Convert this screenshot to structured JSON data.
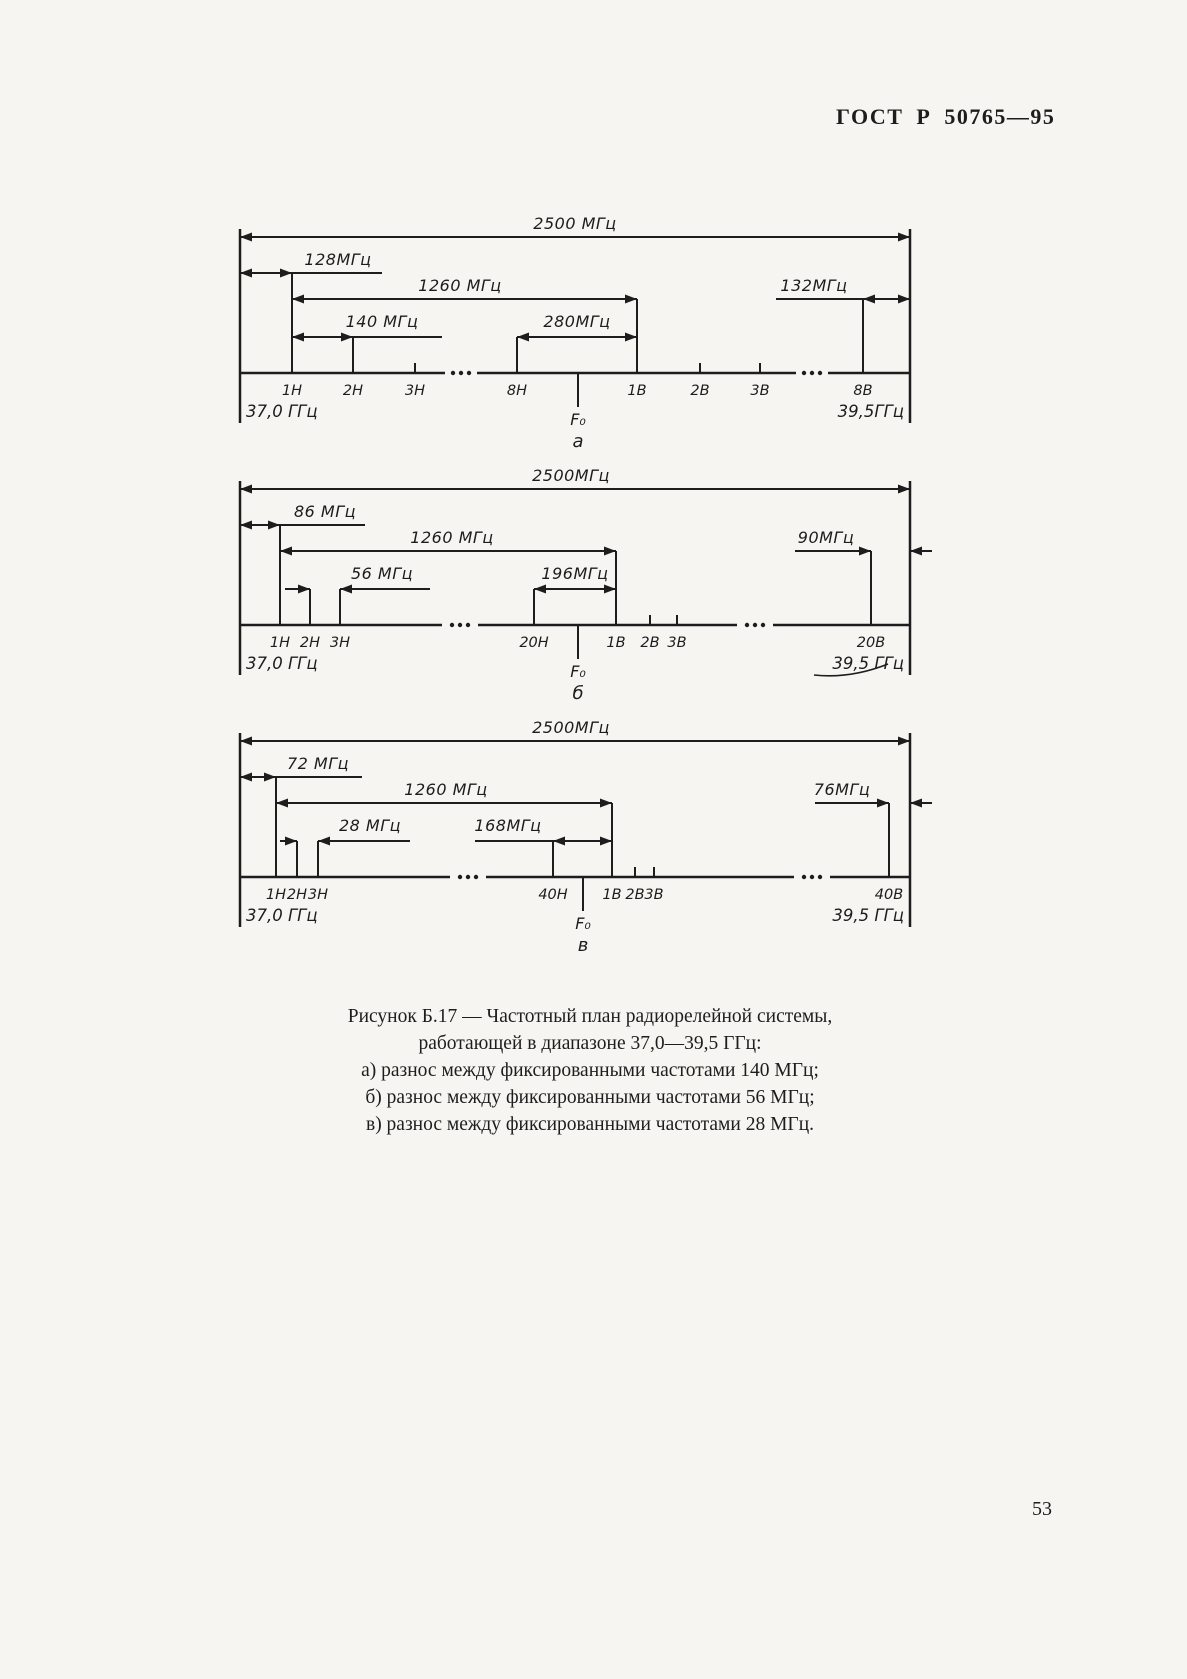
{
  "page": {
    "header": "ГОСТ Р 50765—95",
    "page_number": "53"
  },
  "caption": {
    "title_line1": "Рисунок Б.17 — Частотный план радиорелейной системы,",
    "title_line2": "работающей в диапазоне 37,0—39,5 ГГц:",
    "item_a": "а) разнос между фиксированными частотами 140 МГц;",
    "item_b": "б) разнос между фиксированными частотами 56 МГц;",
    "item_v": "в) разнос между фиксированными частотами 28 МГц."
  },
  "diagrams": [
    {
      "label": "а",
      "dims": {
        "total": "2500 МГц",
        "left_offset": "128МГц",
        "span": "1260 МГц",
        "step": "140 МГц",
        "gap": "280МГц",
        "right_offset": "132МГц"
      },
      "channels": [
        "1Н",
        "2Н",
        "3Н",
        "8Н",
        "1В",
        "2В",
        "3В",
        "8В"
      ],
      "f0": "F₀",
      "freq_left": "37,0 ГГц",
      "freq_right": "39,5ГГц"
    },
    {
      "label": "б",
      "dims": {
        "total": "2500МГц",
        "left_offset": "86 МГц",
        "span": "1260 МГц",
        "step": "56 МГц",
        "gap": "196МГц",
        "right_offset": "90МГц"
      },
      "channels": [
        "1Н",
        "2Н",
        "3Н",
        "20Н",
        "1В",
        "2В",
        "3В",
        "20В"
      ],
      "f0": "F₀",
      "freq_left": "37,0 ГГц",
      "freq_right": "39,5 ГГц"
    },
    {
      "label": "в",
      "dims": {
        "total": "2500МГц",
        "left_offset": "72 МГц",
        "span": "1260 МГц",
        "step": "28 МГц",
        "gap": "168МГц",
        "right_offset": "76МГц"
      },
      "channels": [
        "1Н",
        "2Н",
        "3Н",
        "40Н",
        "1В",
        "2В",
        "3В",
        "40В"
      ],
      "f0": "F₀",
      "freq_left": "37,0 ГГц",
      "freq_right": "39,5 ГГц"
    }
  ]
}
